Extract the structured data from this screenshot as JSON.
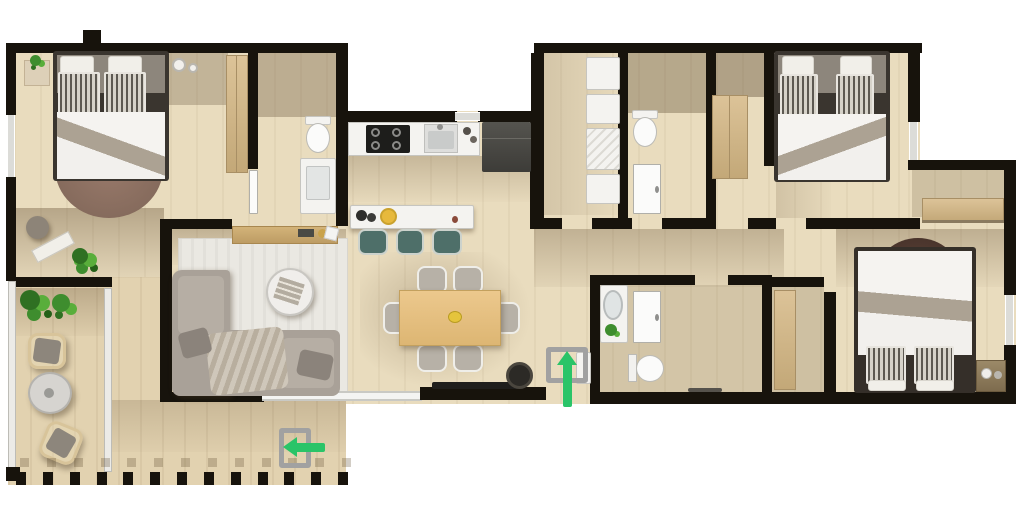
{
  "meta": {
    "type": "floor-plan",
    "style": "photo-real top-down 3D apartment rendering",
    "text_visible": false
  },
  "palette": {
    "wall": "#17130c",
    "floor": "#e9dcbe",
    "terrace_floor": "#e2d2b0",
    "shadow_tint": "#7a5f3c",
    "white_fixture": "#f4f3f0",
    "wood_closet": "#d3b88a",
    "dining_table_wood": "#e6c185",
    "sofa_gray": "#a9a198",
    "living_rug": "#eae8e2",
    "bedroom1_rug": "#8f7365",
    "bedroom3_headboard": "#4a342c",
    "stool_teal": "#4e6f69",
    "entrance_arrow_green": "#2ac468",
    "door_bracket_gray": "#a1a1a1",
    "glass": "#ecebe7"
  },
  "rooms": [
    {
      "id": "bedroom-1",
      "area": "top-left",
      "furniture": [
        "double-bed",
        "striped-pillows",
        "semicircular-rug",
        "nightstand-with-plant",
        "candles",
        "pouf",
        "white-bench",
        "potted-plant",
        "wardrobe"
      ]
    },
    {
      "id": "ensuite-bathroom-1",
      "area": "top-left-center",
      "furniture": [
        "shower-area",
        "toilet",
        "vanity-sink",
        "door"
      ]
    },
    {
      "id": "kitchen",
      "area": "top-center",
      "furniture": [
        "gas-hob",
        "sink",
        "countertop",
        "refrigerator",
        "island-counter",
        "bar-stools-x3",
        "bowls",
        "yellow-plate"
      ]
    },
    {
      "id": "living-room",
      "area": "center-left",
      "furniture": [
        "l-shaped-sofa",
        "throw-blanket",
        "area-rug",
        "round-coffee-table",
        "magazine",
        "sideboard"
      ]
    },
    {
      "id": "dining-area",
      "area": "center",
      "furniture": [
        "wooden-table",
        "chairs-x6",
        "centerpiece-bowl",
        "media-console",
        "planter-pot"
      ]
    },
    {
      "id": "entry-hall",
      "area": "center",
      "furniture": [
        "shoe-cabinet"
      ]
    },
    {
      "id": "utility-room",
      "area": "top-center-right",
      "furniture": [
        "washer",
        "dryer",
        "shelving-units"
      ]
    },
    {
      "id": "bathroom-2",
      "area": "top-center-right",
      "furniture": [
        "shower-area",
        "toilet",
        "door"
      ]
    },
    {
      "id": "hall-closet",
      "area": "top-right",
      "furniture": [
        "wardrobe"
      ]
    },
    {
      "id": "bedroom-2",
      "area": "top-right",
      "furniture": [
        "double-bed",
        "striped-pillows",
        "window"
      ]
    },
    {
      "id": "bathroom-3",
      "area": "center-bottom",
      "furniture": [
        "vanity-with-oval-sink",
        "shower-door",
        "toilet",
        "towel-rail"
      ]
    },
    {
      "id": "hallway",
      "area": "center-right",
      "furniture": [
        "built-in-closet"
      ]
    },
    {
      "id": "bedroom-3",
      "area": "bottom-right",
      "furniture": [
        "double-bed",
        "striped-pillows",
        "dark-half-round-headboard-rug",
        "nightstand",
        "built-in-closet",
        "window"
      ]
    },
    {
      "id": "terrace",
      "area": "bottom-left",
      "furniture": [
        "potted-plants",
        "wicker-chair",
        "wicker-chair",
        "round-side-table",
        "white-bench",
        "glass-partition",
        "railing"
      ]
    }
  ],
  "markers": [
    {
      "id": "main-entrance",
      "symbol": "arrow-up",
      "color": "#2ac468"
    },
    {
      "id": "terrace-entrance",
      "symbol": "arrow-left",
      "color": "#2ac468"
    }
  ],
  "railing": {
    "post_count": 13
  }
}
